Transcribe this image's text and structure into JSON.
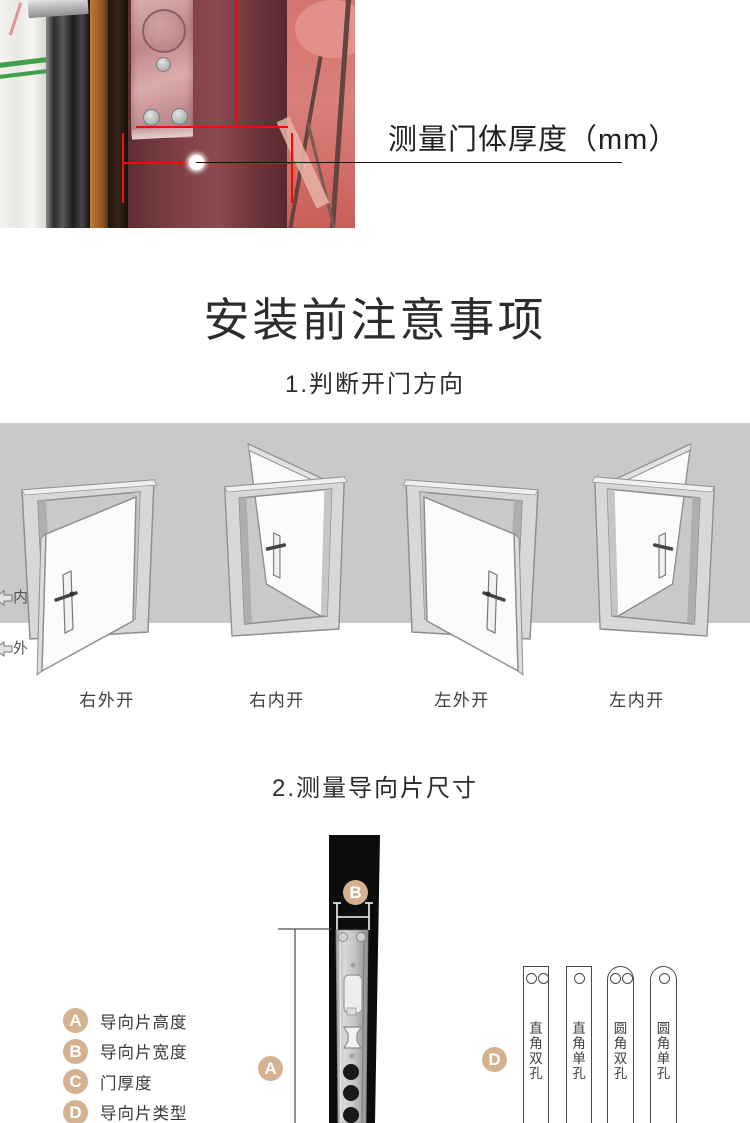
{
  "photo": {
    "callout": "测量门体厚度（mm）",
    "description": "door edge photo with red thickness measurement lines"
  },
  "title": "安装前注意事项",
  "direction": {
    "heading": "1.判断开门方向",
    "inner_label": "内",
    "outer_label": "外",
    "doors": [
      {
        "label": "右外开",
        "hinge": "right",
        "swing": "outward"
      },
      {
        "label": "右内开",
        "hinge": "right",
        "swing": "inward"
      },
      {
        "label": "左外开",
        "hinge": "left",
        "swing": "outward"
      },
      {
        "label": "左内开",
        "hinge": "left",
        "swing": "inward"
      }
    ]
  },
  "measure": {
    "heading": "2.测量导向片尺寸",
    "legend": [
      {
        "key": "A",
        "label": "导向片高度"
      },
      {
        "key": "B",
        "label": "导向片宽度"
      },
      {
        "key": "C",
        "label": "门厚度"
      },
      {
        "key": "D",
        "label": "导向片类型"
      }
    ],
    "plates": [
      {
        "label": "直角双孔",
        "corner": "square",
        "holes": 2
      },
      {
        "label": "直角单孔",
        "corner": "square",
        "holes": 1
      },
      {
        "label": "圆角双孔",
        "corner": "round",
        "holes": 2
      },
      {
        "label": "圆角单孔",
        "corner": "round",
        "holes": 1
      }
    ]
  },
  "colors": {
    "marker_tan": "#d4b190",
    "band_gray": "#c9c9c9",
    "measure_red": "#f50a0a",
    "door_bar_black": "#0c0c0c"
  }
}
